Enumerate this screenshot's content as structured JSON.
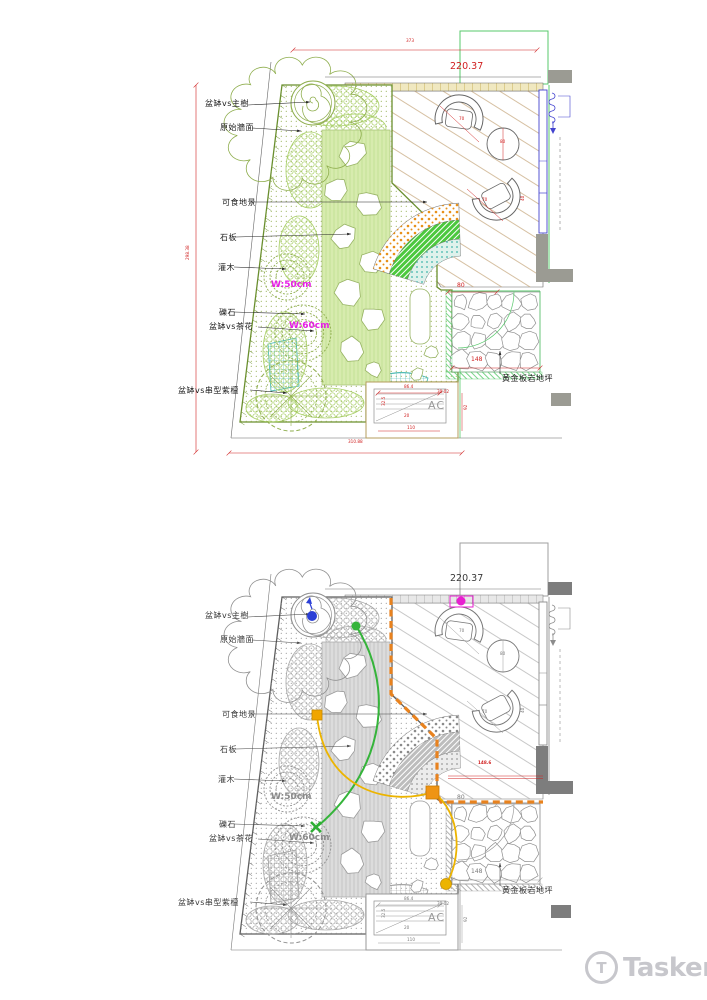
{
  "page": {
    "background": "#ffffff"
  },
  "labels": {
    "main_tree": "盆缽vs主樹",
    "original_wall": "原始牆面",
    "edible": "可食地景",
    "stone_slab": "石板",
    "shrub": "灌木",
    "gravel": "礫石",
    "camellia": "盆缽vs茶花",
    "wisteria": "盆缽vs串型紫檀",
    "golden_slate": "黃金板岩地坪",
    "ac": "AC",
    "w50": "W:50cm",
    "w60": "W:60cm"
  },
  "dims": {
    "overall_top": "373",
    "deck_width": "220.37",
    "site_height": "298.38",
    "site_width": "310.88",
    "slate_width": "80",
    "slate_length": "148",
    "deck_depth_red": "148.6",
    "ac_width": "86.4",
    "ac_inner": "30.02",
    "ac_height": "92",
    "ac_bottom": "110",
    "ac_offset": "20",
    "ac_side": "32.5",
    "chair1": "70",
    "table": "80",
    "chair2": "70",
    "clearance": "40"
  },
  "colors": {
    "dim_red": "#d02020",
    "magenta": "#e61fe6",
    "lawn_green": "#d7ebae",
    "fan_green": "#4cc83e",
    "teal": "#3db3ab",
    "annotation_orange": "#e8821e",
    "annotation_yellow": "#ecb400",
    "annotation_green": "#35b43a",
    "annotation_blue": "#2b3fd6",
    "annotation_magenta": "#e81fd0"
  },
  "watermark": {
    "brand": "Tasker",
    "letter": "T"
  }
}
